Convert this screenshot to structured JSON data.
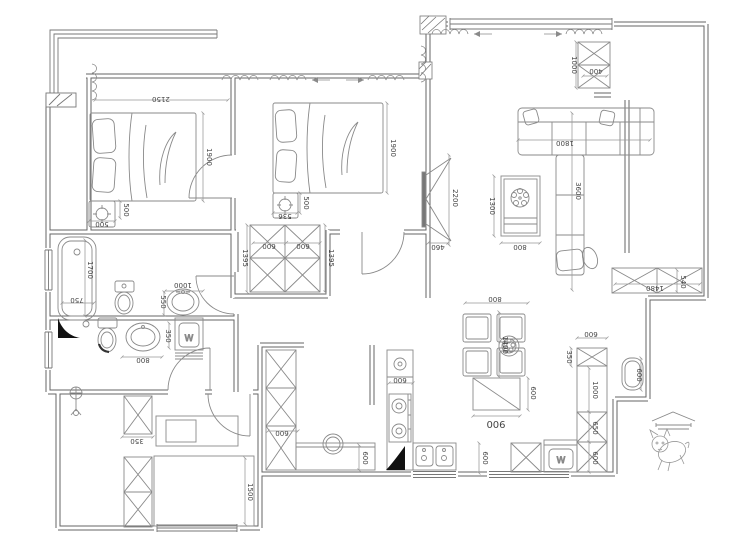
{
  "drawing": {
    "type": "apartment-floor-plan",
    "background": "#ffffff",
    "colors": {
      "wall": "#666666",
      "furniture": "#8a8a8a",
      "dim_line": "#999999",
      "dim_text": "#444444",
      "solid_mark": "#111111"
    }
  },
  "icons": {
    "dog": "dog-sketch",
    "awning": "awning-symbol",
    "floor_drain": "floor-drain",
    "plant": "potted-plant",
    "plate": "flower-plate",
    "curtain": "curtain-scallop"
  },
  "labels": {
    "bedroom1_bed_w": "2150",
    "bedroom1_bed_d": "1900",
    "bedroom1_ns_d": "500",
    "bedroom1_ns_w": "500",
    "bedroom2_bed_d": "1900",
    "bedroom2_ns_w": "536",
    "bedroom2_ns_d": "500",
    "wardrobe_w1": "600",
    "wardrobe_w2": "600",
    "wardrobe_d_left": "1395",
    "wardrobe_d_right": "1395",
    "entry_closet_h": "1000",
    "entry_closet_w": "400",
    "sofa_w": "1800",
    "sofa_l": "3600",
    "tv_wall": "2200",
    "tv_depth": "460",
    "coffee_table_l": "1300",
    "coffee_table_w": "800",
    "hall_cabinet_w": "1480",
    "hall_cabinet_d": "540",
    "stool_right": "600",
    "dining_table_w": "800",
    "dining_table_l": "1400",
    "sideboard_w": "900",
    "sideboard_d": "600",
    "east_cab_w": "600",
    "east_cab_d1": "350",
    "east_cab_d2": "1000",
    "east_cab_d3": "650",
    "east_cab_d4": "600",
    "kitchen_cab_w": "600",
    "kitchen_counter_d": "600",
    "kitchen_stove_w": "600",
    "kitchen_pass": "600",
    "bathtub_l": "1700",
    "bathtub_w": "750",
    "basin1_w": "1000",
    "basin1_d": "550",
    "basin2_w": "800",
    "basin2_d": "350",
    "study_cab_d": "350",
    "study_bed_w": "1500",
    "washer1": "W",
    "washer2": "W"
  }
}
